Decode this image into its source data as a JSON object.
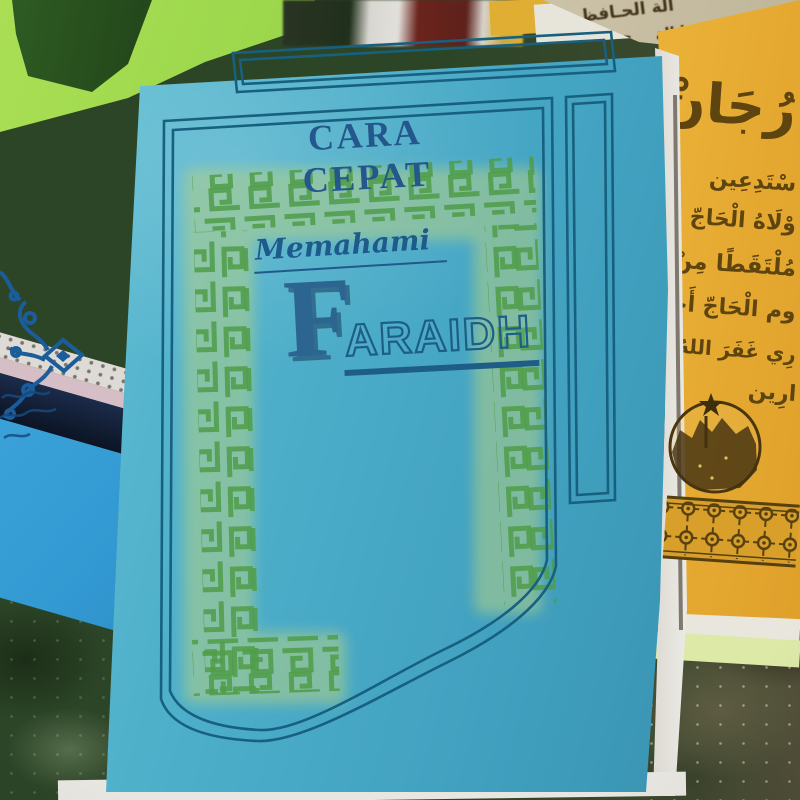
{
  "main_book": {
    "header": "CARA CEPAT",
    "subtitle": "Memahami",
    "title_initial": "F",
    "title_rest": "ARAIDH",
    "colors": {
      "cover_teal": "#46a7c5",
      "ink_blue": "#1d5d86",
      "meander_green": "#4f9c49",
      "meander_halo": "#b3d087"
    }
  },
  "yellow_book": {
    "lines": [
      "رُجَانْ",
      "سْتَدِعِين",
      "وْلَاهُ الْحَاجّ مُحَمَّد",
      "مُلْتَقَطًا مِنْ مَنْقُول",
      "وم الْحَاجّ أَحْمَد",
      "رِي غَفَرَ اللهُ ذُنُوبَه",
      "ارِين"
    ],
    "colors": {
      "cover_yellow": "#e3a52f",
      "ink_brown": "#5e440e"
    }
  },
  "beige_panel": {
    "lines": [
      "الة الحـافظـو",
      "فظو الحـا الة",
      "حـافظ الة و"
    ],
    "colors": {
      "paper": "#c6bda2",
      "ink": "#43351b"
    }
  },
  "blue_book": {
    "colors": {
      "cover_azure": "#3aa0d6",
      "ornament": "#1b5c9a"
    }
  },
  "lime_book": {
    "colors": {
      "cover_lime": "#a0d94f",
      "strip": "#2a5220"
    }
  },
  "carpet": {
    "colors": {
      "left_green": "#2f4829",
      "right_olive": "#514e37"
    }
  }
}
